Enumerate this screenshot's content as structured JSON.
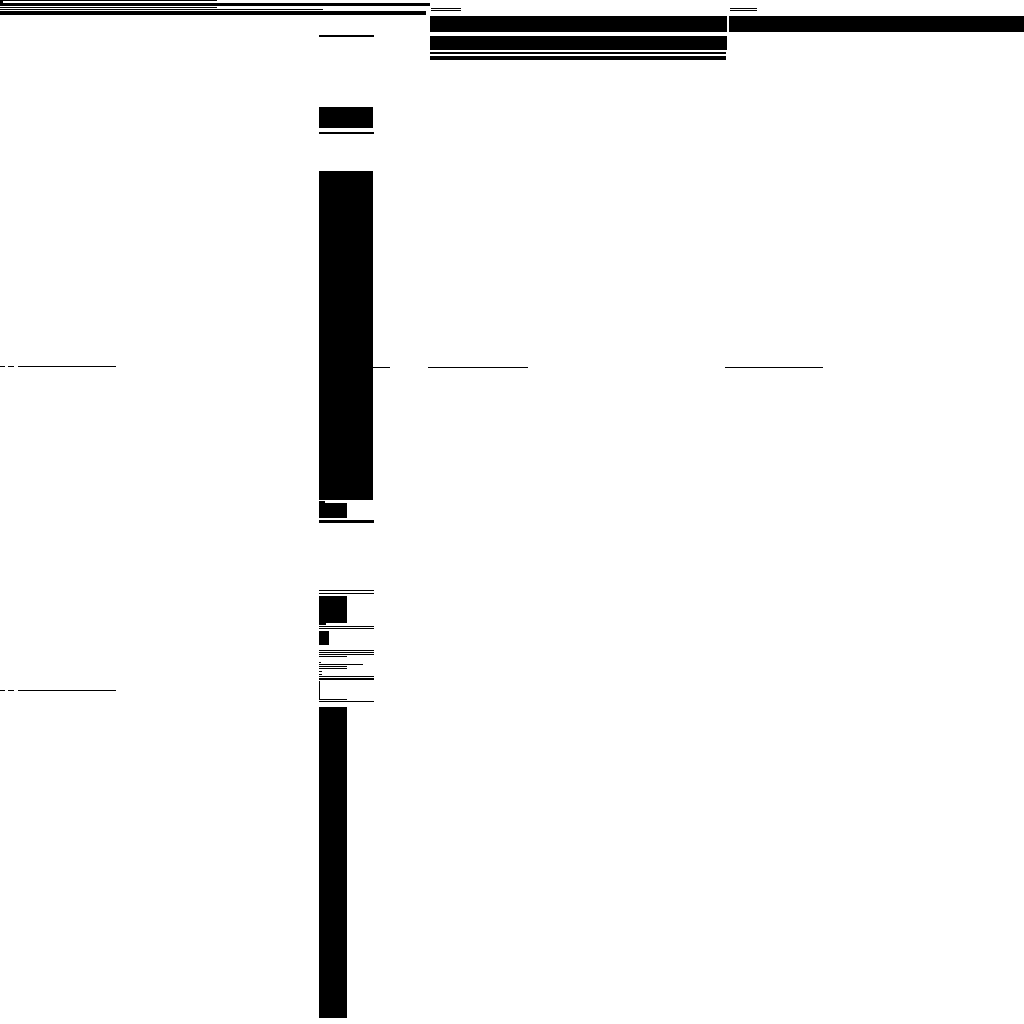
{
  "canvas": {
    "width": 1024,
    "height": 1024,
    "background_color": "#ffffff",
    "ink_color": "#000000",
    "description": "Fully redacted document page: all content rendered as solid black bars, rules and blocks on white"
  },
  "shapes": [
    {
      "name": "masthead-rule-top",
      "group": "masthead",
      "x": 0,
      "y": 0,
      "w": 217,
      "h": 1
    },
    {
      "name": "masthead-tick",
      "group": "masthead",
      "x": 0,
      "y": 1,
      "w": 3,
      "h": 2
    },
    {
      "name": "masthead-bar-1",
      "group": "masthead",
      "x": 0,
      "y": 3,
      "w": 430,
      "h": 3
    },
    {
      "name": "masthead-rule-2",
      "group": "masthead",
      "x": 0,
      "y": 7,
      "w": 217,
      "h": 1
    },
    {
      "name": "masthead-rule-3",
      "group": "masthead",
      "x": 0,
      "y": 9,
      "w": 323,
      "h": 1
    },
    {
      "name": "masthead-bar-2",
      "group": "masthead",
      "x": 0,
      "y": 11,
      "w": 426,
      "h": 4
    },
    {
      "name": "header-left-col-dash-1",
      "group": "header-columns",
      "x": 431,
      "y": 8,
      "w": 30,
      "h": 1
    },
    {
      "name": "header-left-col-dash-2",
      "group": "header-columns",
      "x": 431,
      "y": 10,
      "w": 30,
      "h": 1
    },
    {
      "name": "header-right-col-dash-1",
      "group": "header-columns",
      "x": 730,
      "y": 8,
      "w": 27,
      "h": 1
    },
    {
      "name": "header-right-col-dash-2",
      "group": "header-columns",
      "x": 730,
      "y": 10,
      "w": 27,
      "h": 1
    },
    {
      "name": "header-left-col-bar-1",
      "group": "header-columns",
      "x": 430,
      "y": 16,
      "w": 297,
      "h": 16
    },
    {
      "name": "header-right-col-bar",
      "group": "header-columns",
      "x": 729,
      "y": 16,
      "w": 295,
      "h": 16
    },
    {
      "name": "header-left-col-bar-2",
      "group": "header-columns",
      "x": 430,
      "y": 36,
      "w": 297,
      "h": 14
    },
    {
      "name": "header-left-col-rule",
      "group": "header-columns",
      "x": 430,
      "y": 52,
      "w": 296,
      "h": 2
    },
    {
      "name": "header-left-col-bar-3",
      "group": "header-columns",
      "x": 430,
      "y": 56,
      "w": 296,
      "h": 4
    },
    {
      "name": "center-rule-top",
      "group": "center-column",
      "x": 319,
      "y": 35,
      "w": 55,
      "h": 2
    },
    {
      "name": "center-block-1",
      "group": "center-column",
      "x": 319,
      "y": 107,
      "w": 54,
      "h": 21
    },
    {
      "name": "center-rule-2",
      "group": "center-column",
      "x": 319,
      "y": 132,
      "w": 55,
      "h": 2
    },
    {
      "name": "center-tall-rect",
      "group": "center-column",
      "x": 319,
      "y": 171,
      "w": 54,
      "h": 329
    },
    {
      "name": "center-tick-1",
      "group": "center-column",
      "x": 319,
      "y": 501,
      "w": 6,
      "h": 2
    },
    {
      "name": "center-block-2",
      "group": "center-column",
      "x": 319,
      "y": 503,
      "w": 28,
      "h": 15
    },
    {
      "name": "center-rule-3",
      "group": "center-column",
      "x": 319,
      "y": 520,
      "w": 55,
      "h": 3
    },
    {
      "name": "left-rule-row1-tick-1",
      "group": "rule-row-1",
      "x": 0,
      "y": 366,
      "w": 5,
      "h": 1
    },
    {
      "name": "left-rule-row1-tick-2",
      "group": "rule-row-1",
      "x": 8,
      "y": 366,
      "w": 6,
      "h": 1
    },
    {
      "name": "left-rule-row1",
      "group": "rule-row-1",
      "x": 18,
      "y": 366,
      "w": 98,
      "h": 1
    },
    {
      "name": "center-side-rule",
      "group": "rule-row-1",
      "x": 373,
      "y": 367,
      "w": 17,
      "h": 1
    },
    {
      "name": "mid-rule-row1-a",
      "group": "rule-row-1",
      "x": 428,
      "y": 367,
      "w": 100,
      "h": 1
    },
    {
      "name": "mid-rule-row1-b",
      "group": "rule-row-1",
      "x": 725,
      "y": 367,
      "w": 98,
      "h": 1
    },
    {
      "name": "midsection-rule-a1",
      "group": "mid-section",
      "x": 319,
      "y": 590,
      "w": 55,
      "h": 1
    },
    {
      "name": "midsection-rule-a2",
      "group": "mid-section",
      "x": 319,
      "y": 593,
      "w": 55,
      "h": 1
    },
    {
      "name": "midsection-square",
      "group": "mid-section",
      "x": 319,
      "y": 596,
      "w": 28,
      "h": 27
    },
    {
      "name": "midsection-tick-1",
      "group": "mid-section",
      "x": 319,
      "y": 623,
      "w": 7,
      "h": 2
    },
    {
      "name": "midsection-rule-b1",
      "group": "mid-section",
      "x": 319,
      "y": 626,
      "w": 55,
      "h": 1
    },
    {
      "name": "midsection-rule-b2",
      "group": "mid-section",
      "x": 319,
      "y": 628,
      "w": 55,
      "h": 1
    },
    {
      "name": "midsection-small-rect",
      "group": "mid-section",
      "x": 319,
      "y": 631,
      "w": 10,
      "h": 14
    },
    {
      "name": "midsection-rule-c1",
      "group": "mid-section",
      "x": 319,
      "y": 650,
      "w": 55,
      "h": 1
    },
    {
      "name": "midsection-rule-c2",
      "group": "mid-section",
      "x": 319,
      "y": 652,
      "w": 55,
      "h": 1
    },
    {
      "name": "midsection-rule-c3",
      "group": "mid-section",
      "x": 319,
      "y": 654,
      "w": 55,
      "h": 1
    },
    {
      "name": "midsection-rule-c4",
      "group": "mid-section",
      "x": 319,
      "y": 656,
      "w": 28,
      "h": 1
    },
    {
      "name": "midsection-dot",
      "group": "mid-section",
      "x": 319,
      "y": 662,
      "w": 2,
      "h": 1
    },
    {
      "name": "midsection-rule-d1",
      "group": "mid-section",
      "x": 319,
      "y": 664,
      "w": 44,
      "h": 1
    },
    {
      "name": "midsection-rule-d2",
      "group": "mid-section",
      "x": 319,
      "y": 666,
      "w": 28,
      "h": 1
    },
    {
      "name": "midsection-rule-d3",
      "group": "mid-section",
      "x": 319,
      "y": 668,
      "w": 28,
      "h": 1
    },
    {
      "name": "midsection-tick-2",
      "group": "mid-section",
      "x": 319,
      "y": 671,
      "w": 3,
      "h": 1
    },
    {
      "name": "midsection-tick-3",
      "group": "mid-section",
      "x": 319,
      "y": 674,
      "w": 3,
      "h": 1
    },
    {
      "name": "midsection-rule-e1",
      "group": "mid-section",
      "x": 319,
      "y": 676,
      "w": 55,
      "h": 1
    },
    {
      "name": "midsection-rule-e2",
      "group": "mid-section",
      "x": 319,
      "y": 678,
      "w": 55,
      "h": 2
    },
    {
      "name": "midsection-vertical-rule",
      "group": "mid-section",
      "x": 319,
      "y": 681,
      "w": 1,
      "h": 18
    },
    {
      "name": "midsection-rule-f1",
      "group": "mid-section",
      "x": 319,
      "y": 699,
      "w": 28,
      "h": 1
    },
    {
      "name": "midsection-rule-f2",
      "group": "mid-section",
      "x": 319,
      "y": 701,
      "w": 55,
      "h": 1
    },
    {
      "name": "left-rule-row2-tick-1",
      "group": "rule-row-2",
      "x": 0,
      "y": 690,
      "w": 5,
      "h": 1
    },
    {
      "name": "left-rule-row2-tick-2",
      "group": "rule-row-2",
      "x": 8,
      "y": 690,
      "w": 6,
      "h": 1
    },
    {
      "name": "left-rule-row2",
      "group": "rule-row-2",
      "x": 18,
      "y": 690,
      "w": 98,
      "h": 1
    },
    {
      "name": "bottom-tall-bar",
      "group": "bottom",
      "x": 319,
      "y": 707,
      "w": 28,
      "h": 311
    }
  ]
}
